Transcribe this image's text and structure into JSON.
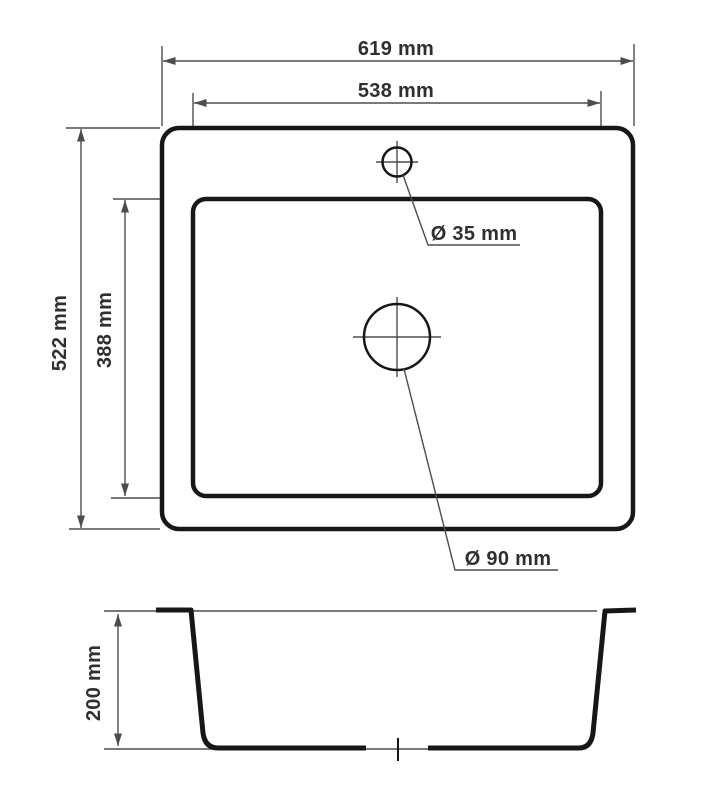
{
  "drawing": {
    "units": "mm",
    "views": {
      "top_view": {
        "outer_width": {
          "value": 619,
          "label": "619 mm"
        },
        "inner_width": {
          "value": 538,
          "label": "538 mm"
        },
        "outer_depth": {
          "value": 522,
          "label": "522 mm"
        },
        "inner_depth": {
          "value": 388,
          "label": "388 mm"
        },
        "faucet_hole_diameter": {
          "value": 35,
          "label": "Ø 35 mm"
        },
        "drain_hole_diameter": {
          "value": 90,
          "label": "Ø 90 mm"
        }
      },
      "section_view": {
        "bowl_depth": {
          "value": 200,
          "label": "200 mm"
        }
      }
    }
  },
  "style": {
    "background": "#ffffff",
    "outline_color": "#171717",
    "dim_color": "#4d4d4d",
    "text_color": "#2f2f2f"
  }
}
